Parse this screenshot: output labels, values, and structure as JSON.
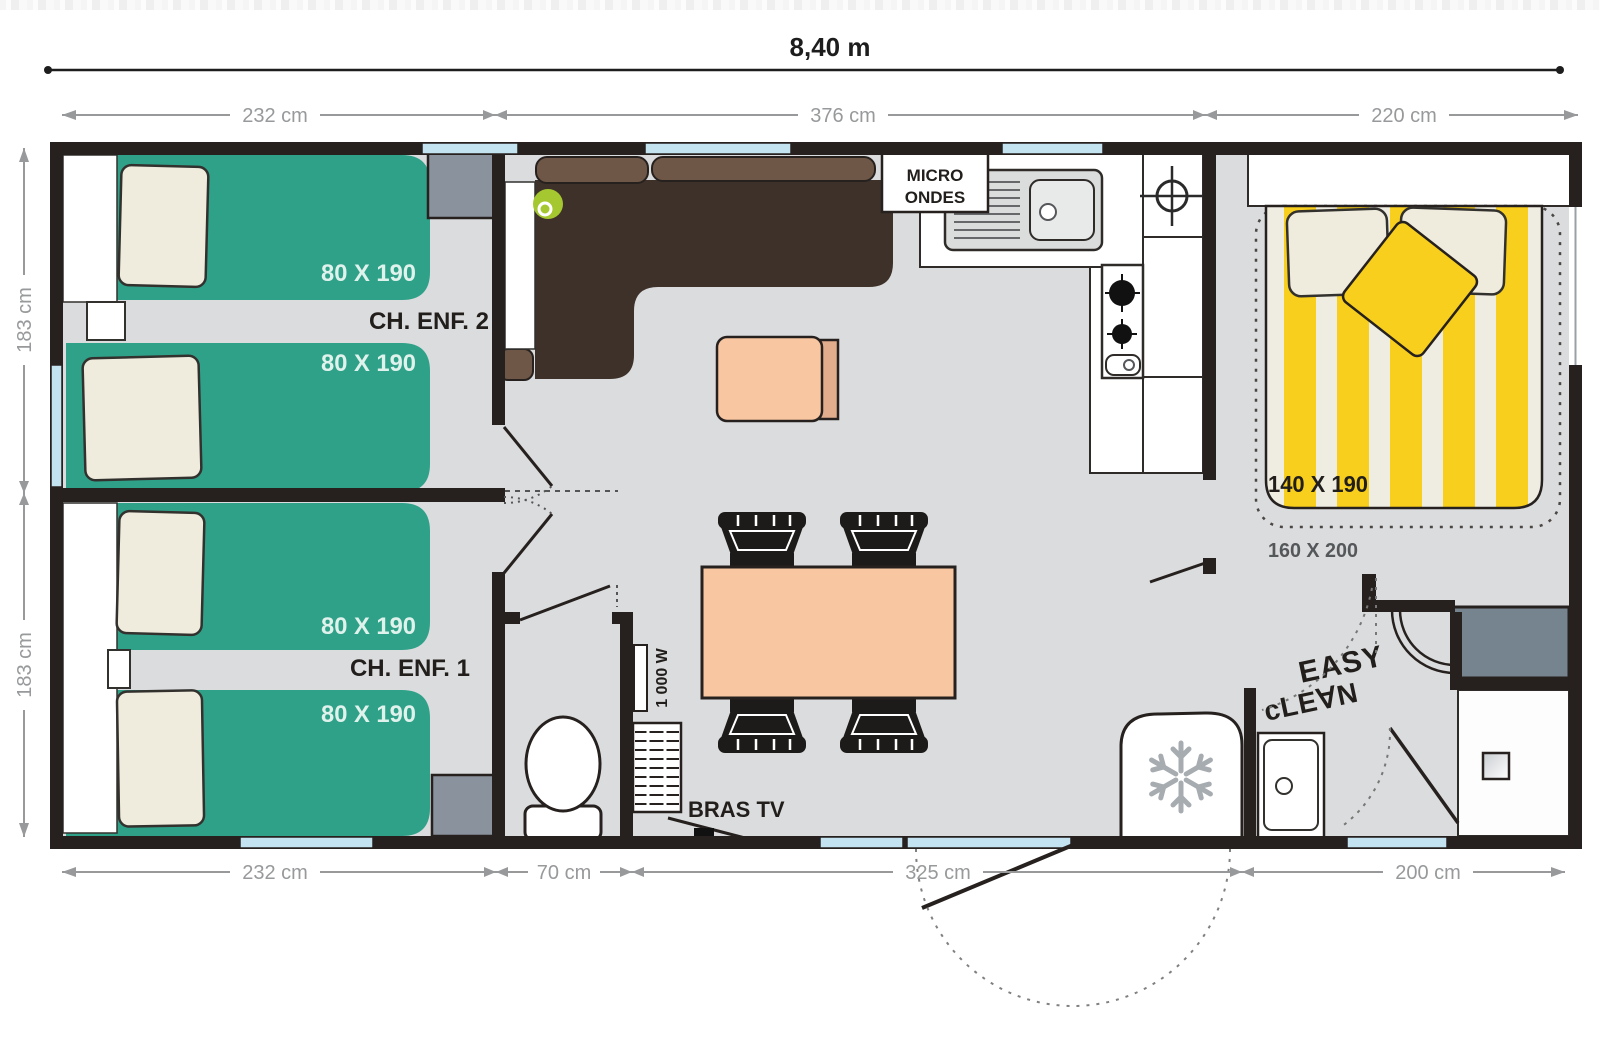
{
  "plan": {
    "type": "mobile-home floor plan",
    "overall_width_label": "8,40 m"
  },
  "dims": {
    "top": [
      "232 cm",
      "376 cm",
      "220 cm"
    ],
    "bottom": [
      "232 cm",
      "70 cm",
      "325 cm",
      "200 cm"
    ],
    "left": [
      "183 cm",
      "183 cm"
    ]
  },
  "rooms": {
    "child_bedroom_2": {
      "label": "CH. ENF. 2",
      "bed_top": "80 X 190",
      "bed_bottom": "80 X 190"
    },
    "child_bedroom_1": {
      "label": "CH. ENF. 1",
      "bed_top": "80 X 190",
      "bed_bottom": "80 X 190"
    },
    "master_bedroom": {
      "bed": "140 X 190",
      "footprint": "160 X 200"
    }
  },
  "labels": {
    "microwave_line1": "MICRO",
    "microwave_line2": "ONDES",
    "tv_arm": "BRAS TV",
    "water_heater": "1 000 W",
    "logo_line1": "EASY",
    "logo_line2": "cLE∀N"
  },
  "icons": [
    "snowflake-icon",
    "ceiling-light-icon",
    "burner-icon",
    "sink-icon",
    "door-swing-arc"
  ],
  "colors": {
    "wall": "#26211F",
    "floor": "#DBDCDD",
    "bed_green": "#2FA189",
    "bed_yellow": "#F8CF1C",
    "bed_cream": "#EFEDE2",
    "pillow": "#EFEBDD",
    "sofa_dark": "#3E3129",
    "sofa_light": "#6E5746",
    "table_salmon": "#F8C7A2",
    "window_blue": "#C3E3F0",
    "wardrobe_gray": "#8A929D",
    "dim_gray": "#97999B",
    "lamp_green": "#A5C72F"
  }
}
